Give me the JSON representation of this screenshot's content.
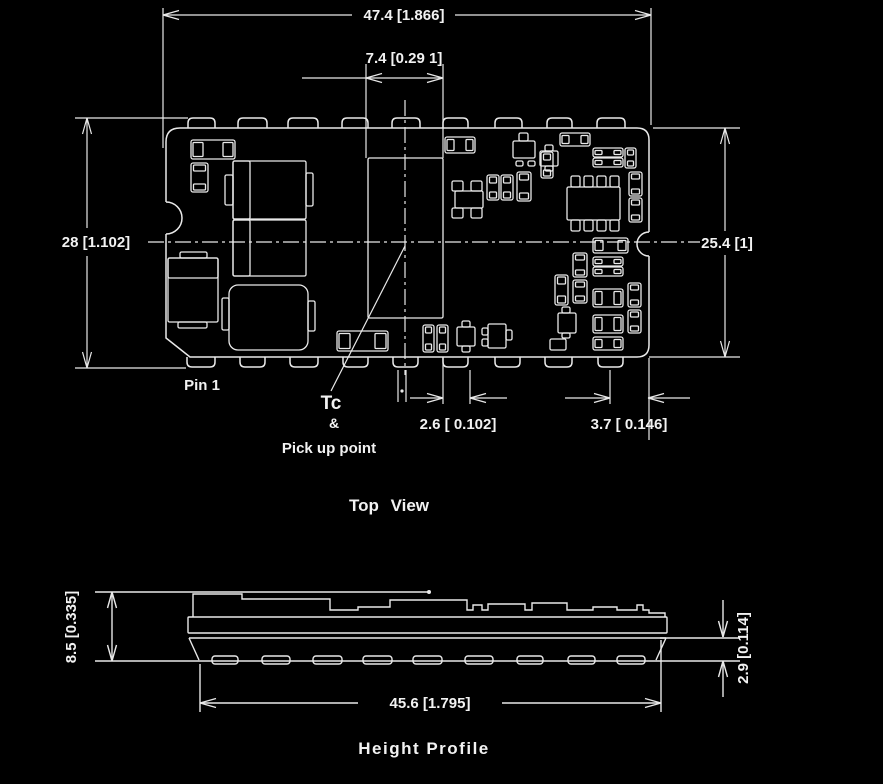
{
  "colors": {
    "background": "#000000",
    "line": "#e9e9e9",
    "text": "#f2f2f2"
  },
  "top_view": {
    "title": "Top View",
    "dimensions": {
      "board_width": "47.4 [1.866]",
      "center_component_width": "7.4 [0.29 1]",
      "overall_height": "28 [1.102]",
      "board_height": "25.4 [1]",
      "pin_width": "2.6 [ 0.102]",
      "pin_edge_offset": "3.7 [ 0.146]"
    },
    "labels": {
      "pin1": "Pin 1",
      "tc": "Tc",
      "ampersand": "&",
      "pickup_point": "Pick up point"
    }
  },
  "height_profile": {
    "title": "Height Profile",
    "dimensions": {
      "total_height": "8.5 [0.335]",
      "body_length": "45.6 [1.795]",
      "standoff_height": "2.9 [0.114]"
    }
  }
}
